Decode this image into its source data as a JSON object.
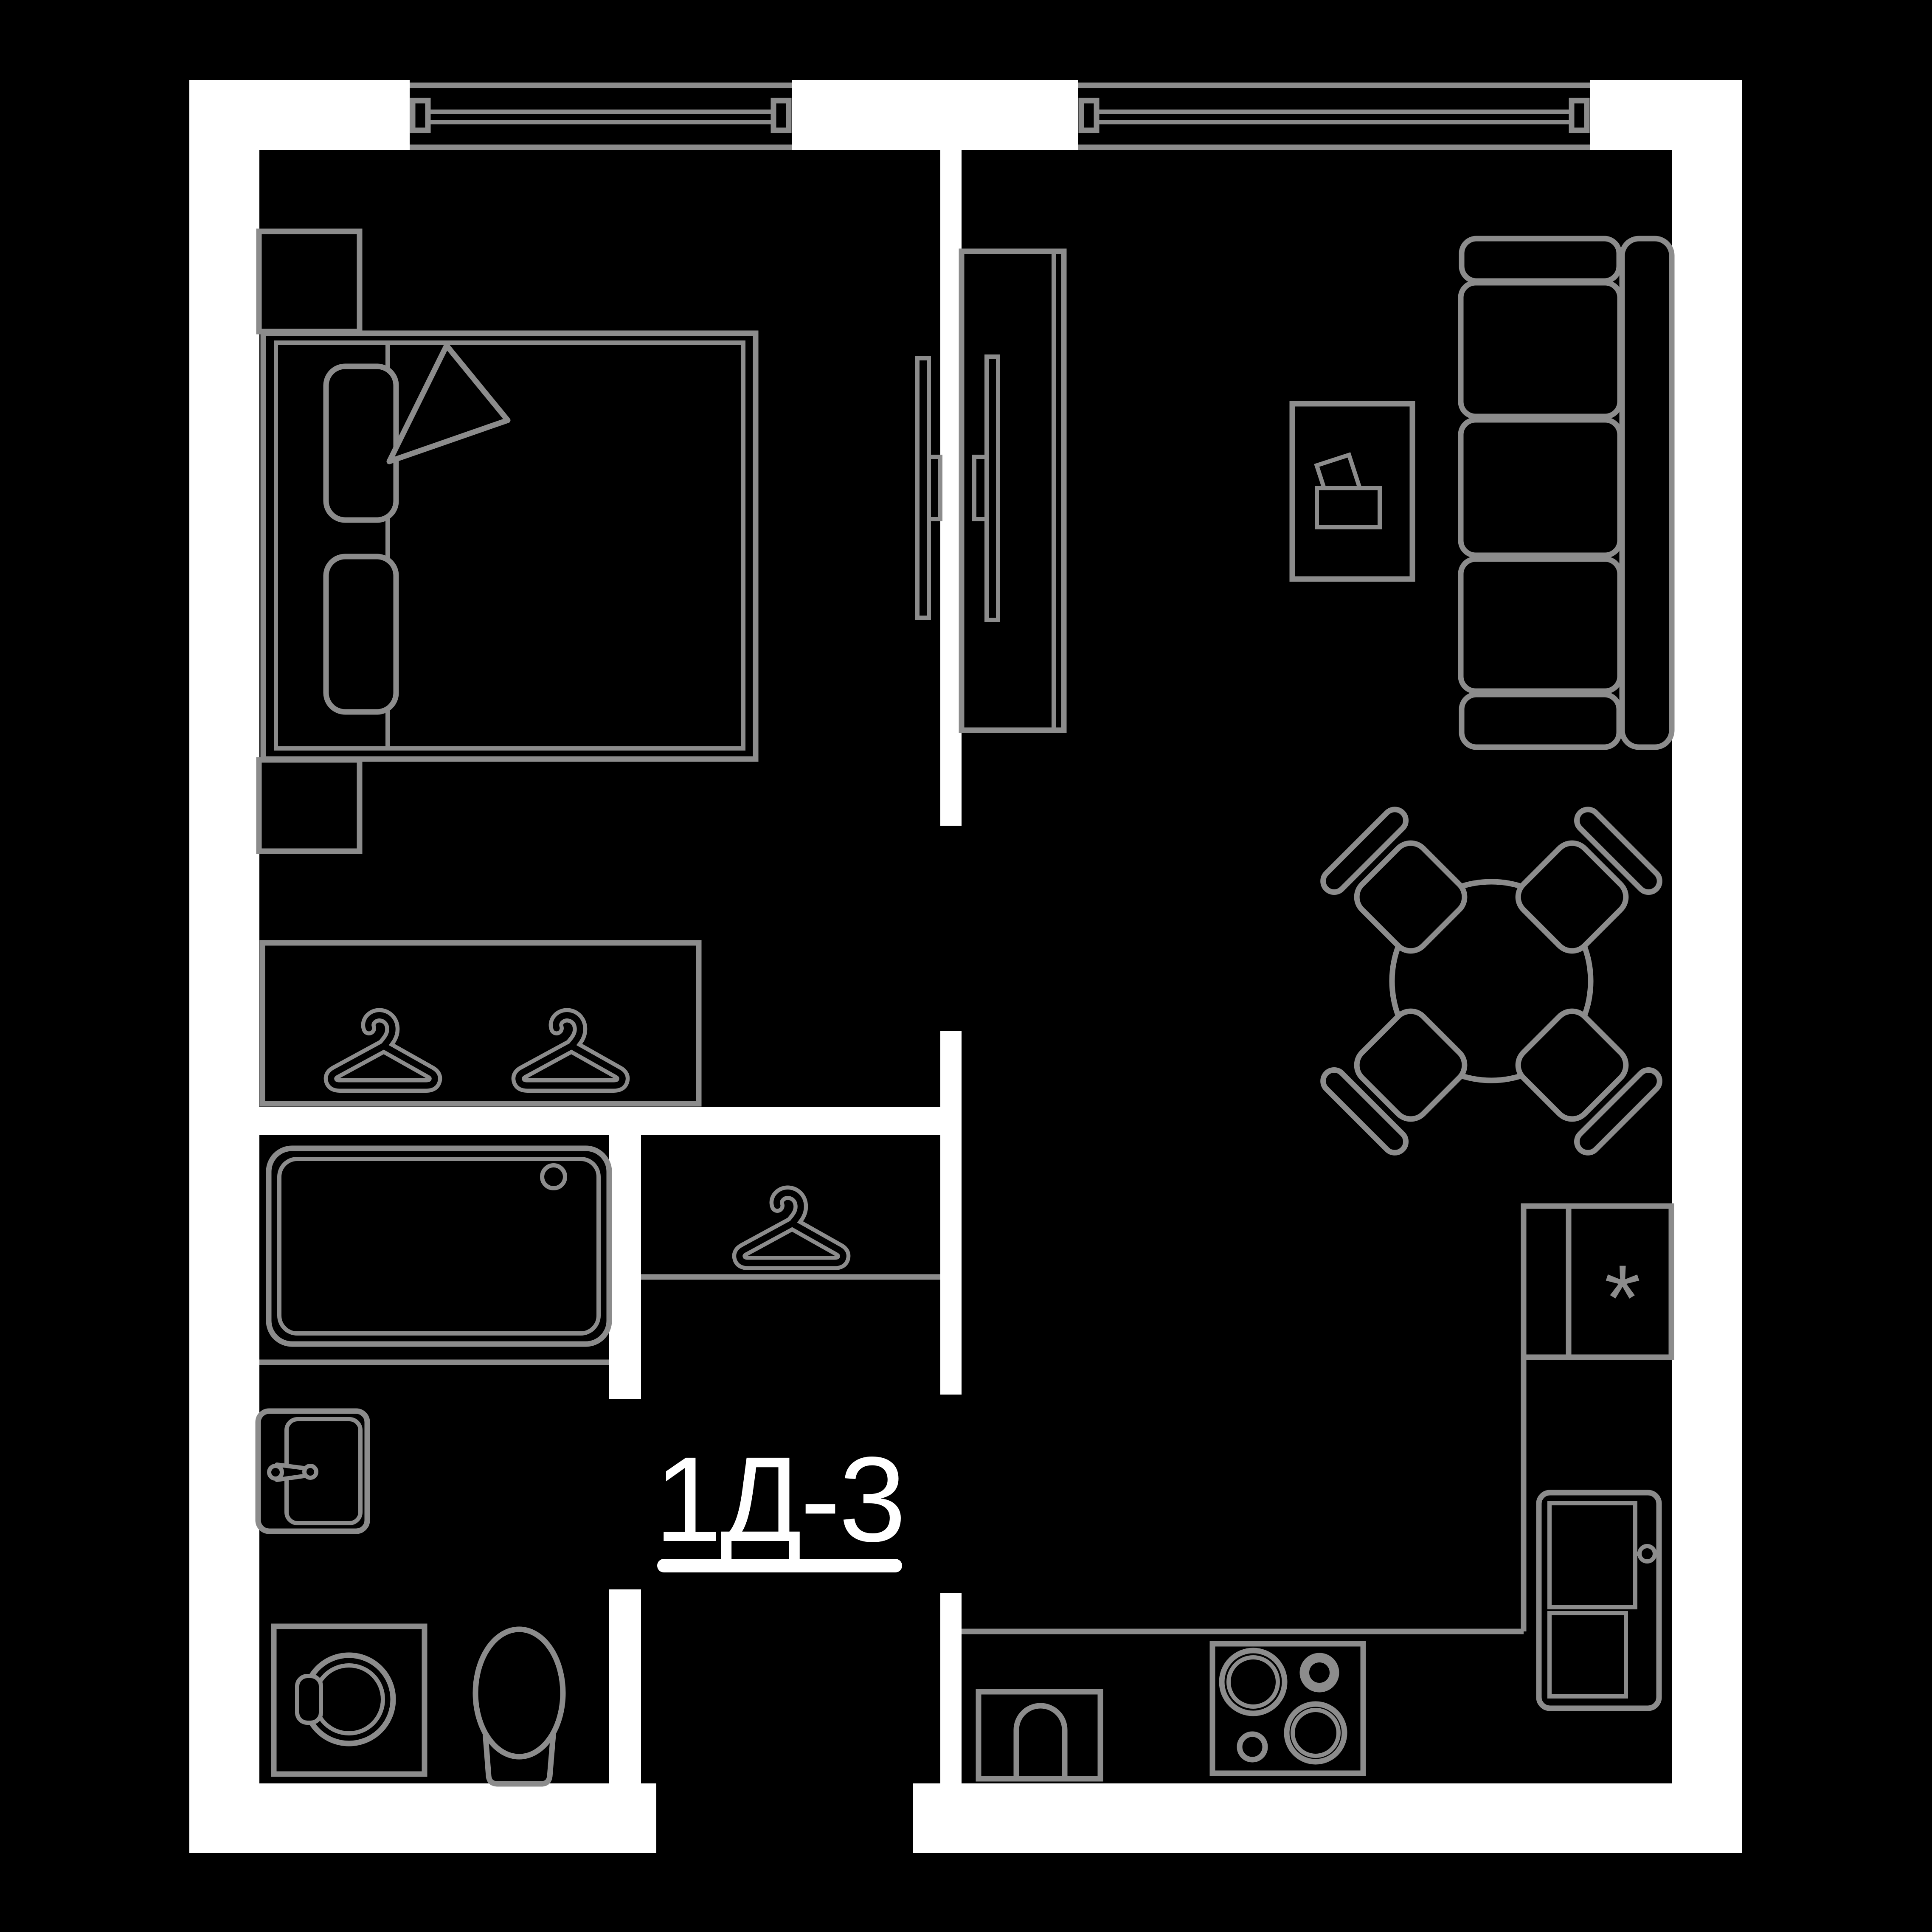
{
  "colors": {
    "bg": "#000000",
    "wall": "#ffffff",
    "line": "#8c8c8c",
    "text": "#ffffff"
  },
  "plan": {
    "label": "1Д-3",
    "refrigerator_symbol": "*"
  },
  "inventory": {
    "rooms": [
      "bedroom",
      "living-room-with-kitchen",
      "bathroom",
      "hallway",
      "wardrobe-niche",
      "coat-closet"
    ],
    "bedroom_items": [
      "double-bed",
      "pillows",
      "folded-blanket",
      "nightstand-top",
      "nightstand-bottom",
      "wall-tv"
    ],
    "living_items": [
      "media-stand",
      "tv",
      "coffee-table",
      "three-seat-sofa",
      "round-dining-table",
      "four-chairs"
    ],
    "bathroom_items": [
      "bathtub",
      "washbasin",
      "washing-machine",
      "toilet"
    ],
    "kitchen_items": [
      "counter",
      "refrigerator-box-with-asterisk",
      "refrigerator",
      "kitchen-sink",
      "cooktop"
    ],
    "storage_items": [
      "two-clothes-hangers",
      "single-clothes-hanger"
    ],
    "openings": [
      "window-bedroom",
      "window-living-room",
      "bedroom-doorway",
      "bathroom-doorway",
      "hall-doorway",
      "entrance-opening"
    ]
  }
}
